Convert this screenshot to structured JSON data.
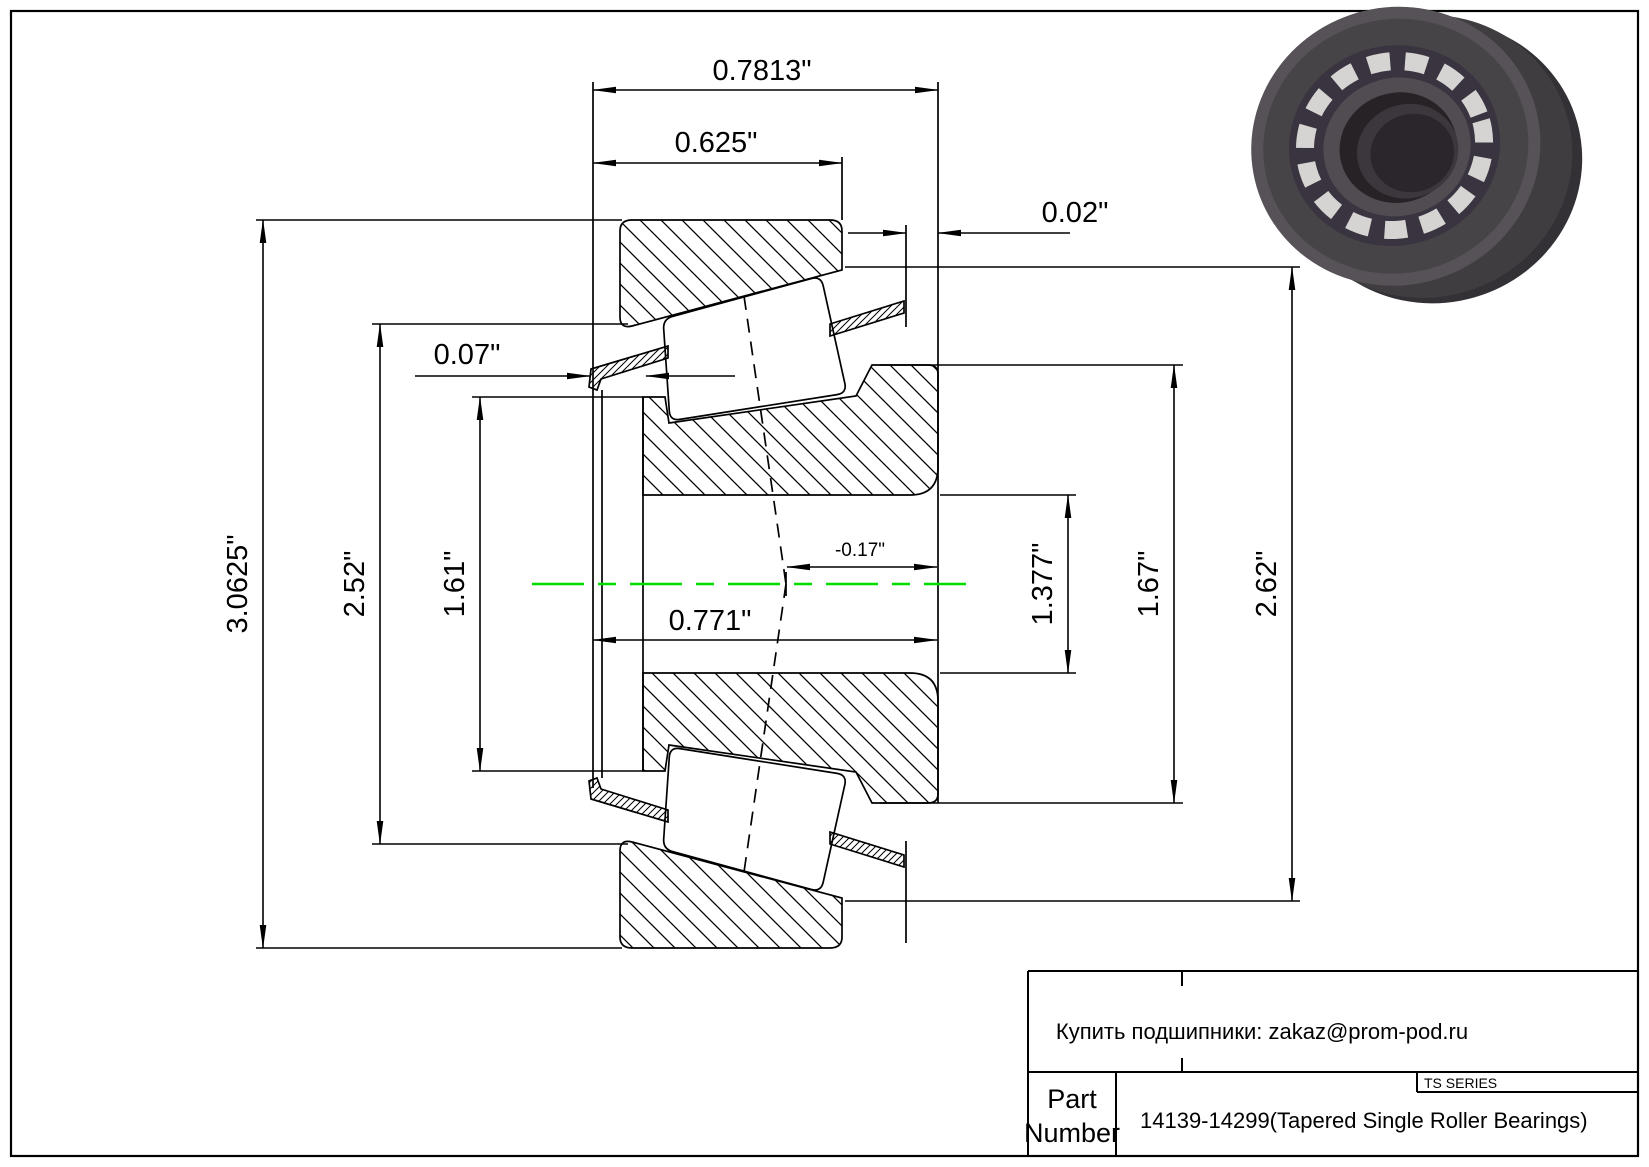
{
  "drawing": {
    "type": "tapered-single-roller-bearing-cross-section",
    "line_color": "#000000",
    "centerline_color": "#00dd00",
    "dimensions": {
      "overall_width": "0.7813\"",
      "cup_width": "0.625\"",
      "cup_back_standout": "0.02\"",
      "cage_front_standout": "0.07\"",
      "cup_od": "3.0625\"",
      "cup_front_id": "2.52\"",
      "cone_front_rib_od": "1.61\"",
      "cone_width": "0.771\"",
      "effective_load_center": "-0.17\"",
      "bore": "1.377\"",
      "cone_rib_od": "1.67\"",
      "cup_back_id": "2.62\""
    }
  },
  "title_block": {
    "contact": "Купить подшипники: zakaz@prom-pod.ru",
    "series_badge": "TS SERIES",
    "part_label_line1": "Part",
    "part_label_line2": "Number",
    "part_value": "14139-14299(Tapered Single Roller Bearings)"
  }
}
